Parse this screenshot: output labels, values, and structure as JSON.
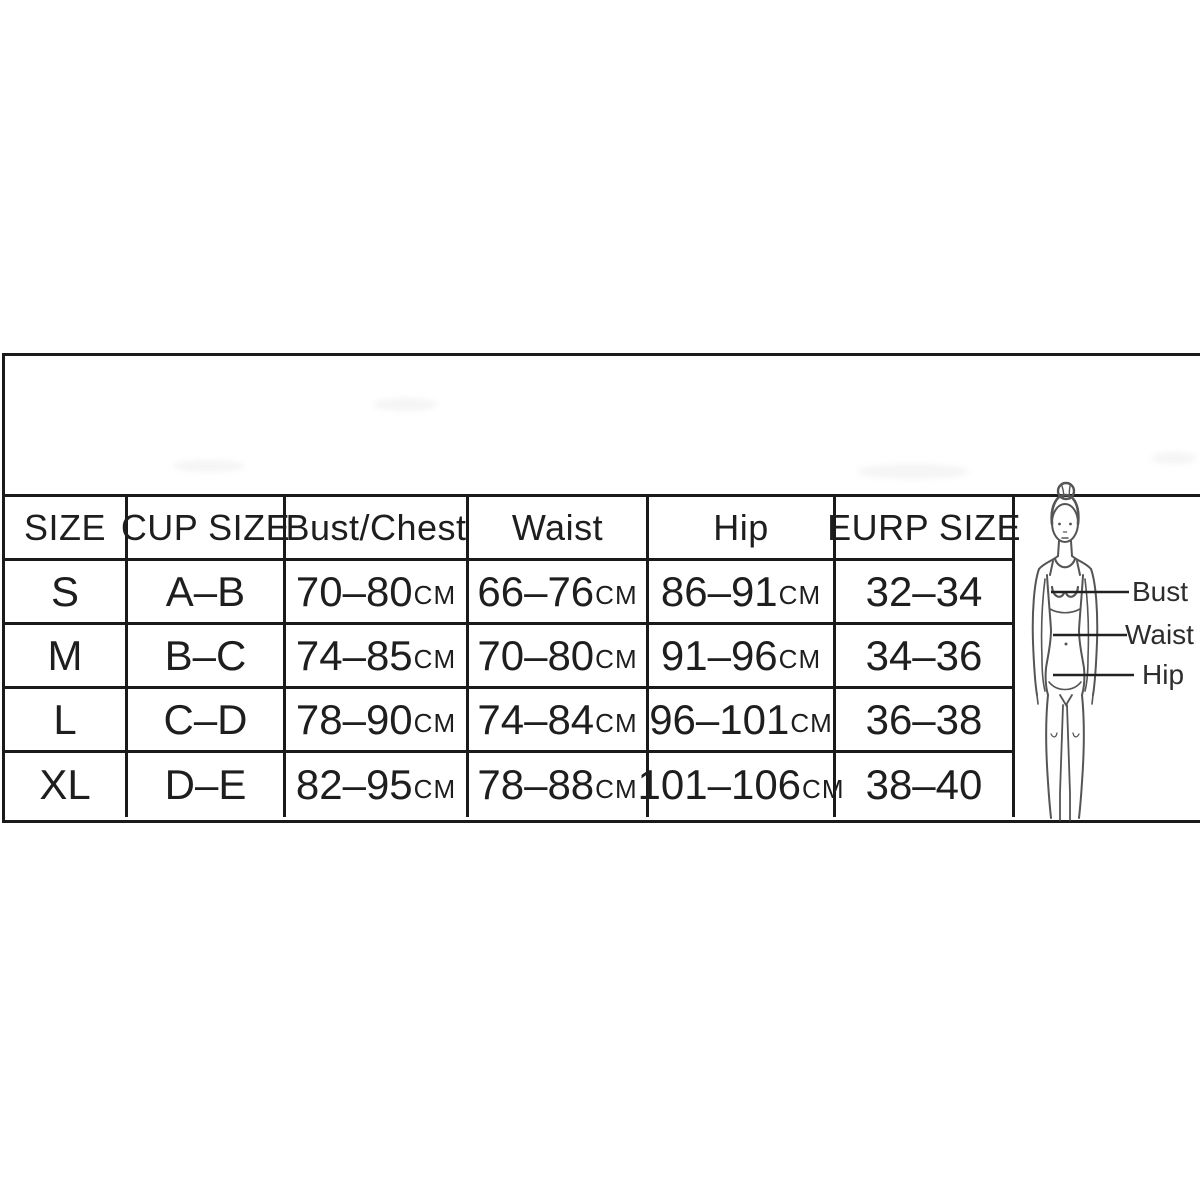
{
  "table": {
    "headers": [
      "SIZE",
      "CUP SIZE",
      "Bust/Chest",
      "Waist",
      "Hip",
      "EURP SIZE"
    ],
    "unit": "CM",
    "rows": [
      {
        "size": "S",
        "cup": "A–B",
        "bust": "70–80",
        "waist": "66–76",
        "hip": "86–91",
        "eurp": "32–34"
      },
      {
        "size": "M",
        "cup": "B–C",
        "bust": "74–85",
        "waist": "70–80",
        "hip": "91–96",
        "eurp": "34–36"
      },
      {
        "size": "L",
        "cup": "C–D",
        "bust": "78–90",
        "waist": "74–84",
        "hip": "96–101",
        "eurp": "36–38"
      },
      {
        "size": "XL",
        "cup": "D–E",
        "bust": "82–95",
        "waist": "78–88",
        "hip": "101–106",
        "eurp": "38–40"
      }
    ]
  },
  "figure": {
    "labels": {
      "bust": "Bust",
      "waist": "Waist",
      "hip": "Hip"
    }
  },
  "colors": {
    "border": "#1a1a1a",
    "text": "#1e1e1e",
    "sketch": "#555555"
  }
}
